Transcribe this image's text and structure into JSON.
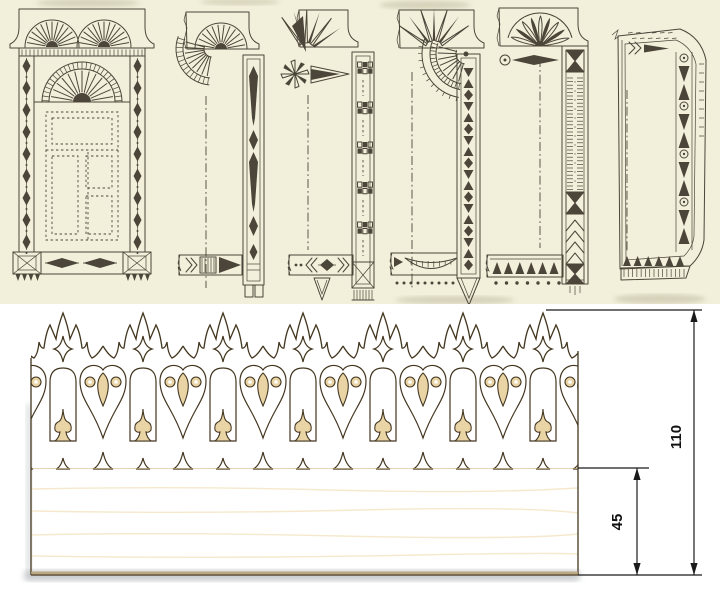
{
  "page": {
    "kind": "carved-window-trim-plate-and-fretwork-board"
  },
  "engraving_plate": {
    "background_color": "#f2f0db",
    "ink_color": "#4c463a",
    "designs": [
      {
        "id": "design-1-full-window-frame-with-twin-fans"
      },
      {
        "id": "design-2-corner-sample-fan-cornice-and-spear-column"
      },
      {
        "id": "design-3-corner-sample-folded-crest-and-checker-column"
      },
      {
        "id": "design-4-corner-sample-leaf-crest-wheel-fan-and-drop-column"
      },
      {
        "id": "design-5-corner-sample-petal-fan-and-hatched-column"
      },
      {
        "id": "design-6-chamfered-frame-with-arrow-and-bead-column"
      }
    ]
  },
  "fretwork_photo": {
    "background_color": "#ffffff",
    "wood_light": "#eedbb2",
    "wood_dark": "#d9c191",
    "cut_edge_color": "#43361f"
  },
  "dimensions": {
    "total_height": "110",
    "plain_band_height": "45",
    "line_color": "#1a1a1a"
  }
}
